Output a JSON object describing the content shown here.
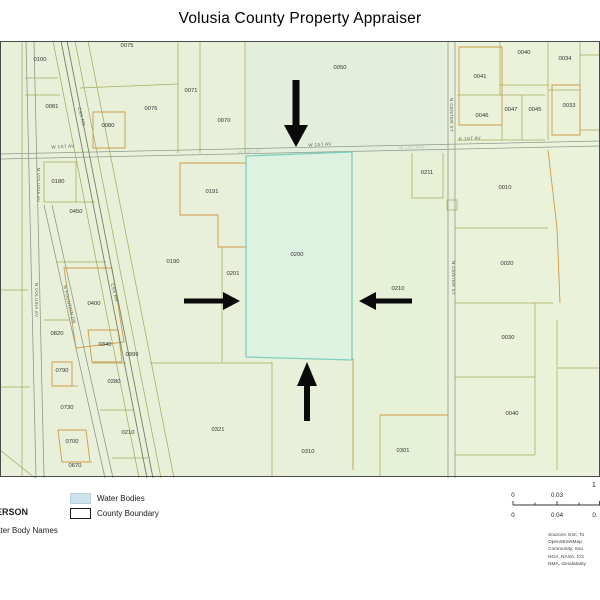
{
  "title": "Volusia County Property Appraiser",
  "map": {
    "highlight_parcel": "0200",
    "parcel_labels": [
      {
        "id": "0100",
        "x": 40,
        "y": 61
      },
      {
        "id": "0075",
        "x": 127,
        "y": 47
      },
      {
        "id": "0071",
        "x": 191,
        "y": 92
      },
      {
        "id": "0076",
        "x": 151,
        "y": 110
      },
      {
        "id": "0081",
        "x": 52,
        "y": 108
      },
      {
        "id": "0080",
        "x": 108,
        "y": 127
      },
      {
        "id": "0070",
        "x": 224,
        "y": 122
      },
      {
        "id": "0050",
        "x": 340,
        "y": 69
      },
      {
        "id": "0040",
        "x": 524,
        "y": 54
      },
      {
        "id": "0034",
        "x": 565,
        "y": 60
      },
      {
        "id": "0041",
        "x": 480,
        "y": 78
      },
      {
        "id": "0033",
        "x": 569,
        "y": 107
      },
      {
        "id": "0046",
        "x": 482,
        "y": 117
      },
      {
        "id": "0047",
        "x": 511,
        "y": 111
      },
      {
        "id": "0045",
        "x": 535,
        "y": 111
      },
      {
        "id": "0180",
        "x": 58,
        "y": 183
      },
      {
        "id": "0191",
        "x": 212,
        "y": 193
      },
      {
        "id": "0211",
        "x": 427,
        "y": 174
      },
      {
        "id": "0010",
        "x": 505,
        "y": 189
      },
      {
        "id": "0450",
        "x": 76,
        "y": 213
      },
      {
        "id": "0190",
        "x": 173,
        "y": 263
      },
      {
        "id": "0201",
        "x": 233,
        "y": 275
      },
      {
        "id": "0200",
        "x": 297,
        "y": 256
      },
      {
        "id": "0210",
        "x": 398,
        "y": 290
      },
      {
        "id": "0020",
        "x": 507,
        "y": 265
      },
      {
        "id": "0400",
        "x": 94,
        "y": 305
      },
      {
        "id": "0820",
        "x": 57,
        "y": 335
      },
      {
        "id": "0340",
        "x": 105,
        "y": 346
      },
      {
        "id": "0999",
        "x": 132,
        "y": 356
      },
      {
        "id": "0790",
        "x": 62,
        "y": 372
      },
      {
        "id": "0280",
        "x": 114,
        "y": 383
      },
      {
        "id": "0730",
        "x": 67,
        "y": 409
      },
      {
        "id": "0210",
        "x": 128,
        "y": 434
      },
      {
        "id": "0700",
        "x": 72,
        "y": 443
      },
      {
        "id": "0670",
        "x": 75,
        "y": 467
      },
      {
        "id": "0321",
        "x": 218,
        "y": 431
      },
      {
        "id": "0310",
        "x": 308,
        "y": 453
      },
      {
        "id": "0301",
        "x": 403,
        "y": 452
      },
      {
        "id": "0030",
        "x": 508,
        "y": 339
      },
      {
        "id": "0040",
        "x": 512,
        "y": 415
      }
    ],
    "street_labels": [
      {
        "text": "W 1ST AV",
        "x": 63,
        "y": 148,
        "rot": -3,
        "faint": false
      },
      {
        "text": "W 1ST AV",
        "x": 320,
        "y": 146,
        "rot": -3,
        "faint": false
      },
      {
        "text": "W 1ST AV",
        "x": 250,
        "y": 153,
        "rot": -3,
        "faint": true
      },
      {
        "text": "W 1ST AVE",
        "x": 412,
        "y": 149,
        "rot": -3,
        "faint": true
      },
      {
        "text": "E 1ST AV",
        "x": 470,
        "y": 140,
        "rot": -3,
        "faint": false
      },
      {
        "text": "N VOLUSIA AV",
        "x": 37,
        "y": 185,
        "rot": 90,
        "faint": false
      },
      {
        "text": "N VOLUSIA AV",
        "x": 35,
        "y": 300,
        "rot": 90,
        "faint": false
      },
      {
        "text": "N CENTER ST",
        "x": 450,
        "y": 115,
        "rot": 90,
        "faint": false
      },
      {
        "text": "N CENTER ST",
        "x": 452,
        "y": 278,
        "rot": 90,
        "faint": false
      },
      {
        "text": "CSX RR",
        "x": 80,
        "y": 117,
        "rot": 76,
        "faint": false
      },
      {
        "text": "CSX RR",
        "x": 113,
        "y": 293,
        "rot": 76,
        "faint": false
      },
      {
        "text": "N FOUNTAIN DR",
        "x": 68,
        "y": 305,
        "rot": 76,
        "faint": false
      }
    ],
    "arrows": [
      {
        "dir": "down",
        "x": 296,
        "y": 147,
        "len": 67,
        "hw": 12,
        "hl": 22,
        "sw": 3.5
      },
      {
        "dir": "right",
        "x": 240,
        "y": 301,
        "len": 56,
        "hw": 9,
        "hl": 17,
        "sw": 2.5
      },
      {
        "dir": "left",
        "x": 359,
        "y": 301,
        "len": 53,
        "hw": 9,
        "hl": 17,
        "sw": 2.5
      },
      {
        "dir": "up",
        "x": 307,
        "y": 362,
        "len": 59,
        "hw": 10,
        "hl": 24,
        "sw": 3
      }
    ]
  },
  "legend": {
    "items": [
      {
        "label": "Water Bodies",
        "swatch_color": "#cfe3ed",
        "swatch_border": "#b9cfdd"
      },
      {
        "label": "County Boundary",
        "swatch_color": "#ffffff",
        "swatch_border": "#1a1a1a"
      }
    ],
    "cutoff_text_1": "ERSON",
    "cutoff_text_2": "ater Body Names"
  },
  "scalebar": {
    "ratio_text": "1",
    "top_labels": [
      "0",
      "0.03"
    ],
    "bottom_labels": [
      "0",
      "0.04",
      "0."
    ]
  },
  "sources_lines": [
    "Sources: Esri, To",
    "OpenStreetMap",
    "Community, Sou",
    "NGA, NASA, CG",
    "NMA, Geodatasty"
  ],
  "colors": {
    "map_background": "#e8f0d9",
    "highlight_fill": "#def2e2",
    "highlight_stroke": "#7ccfbc",
    "parcel_line": "#a9ab5e",
    "parcel_line_alt": "#cf9a45",
    "street_line": "#8e9a8e",
    "arrow": "#0a0a0a"
  }
}
